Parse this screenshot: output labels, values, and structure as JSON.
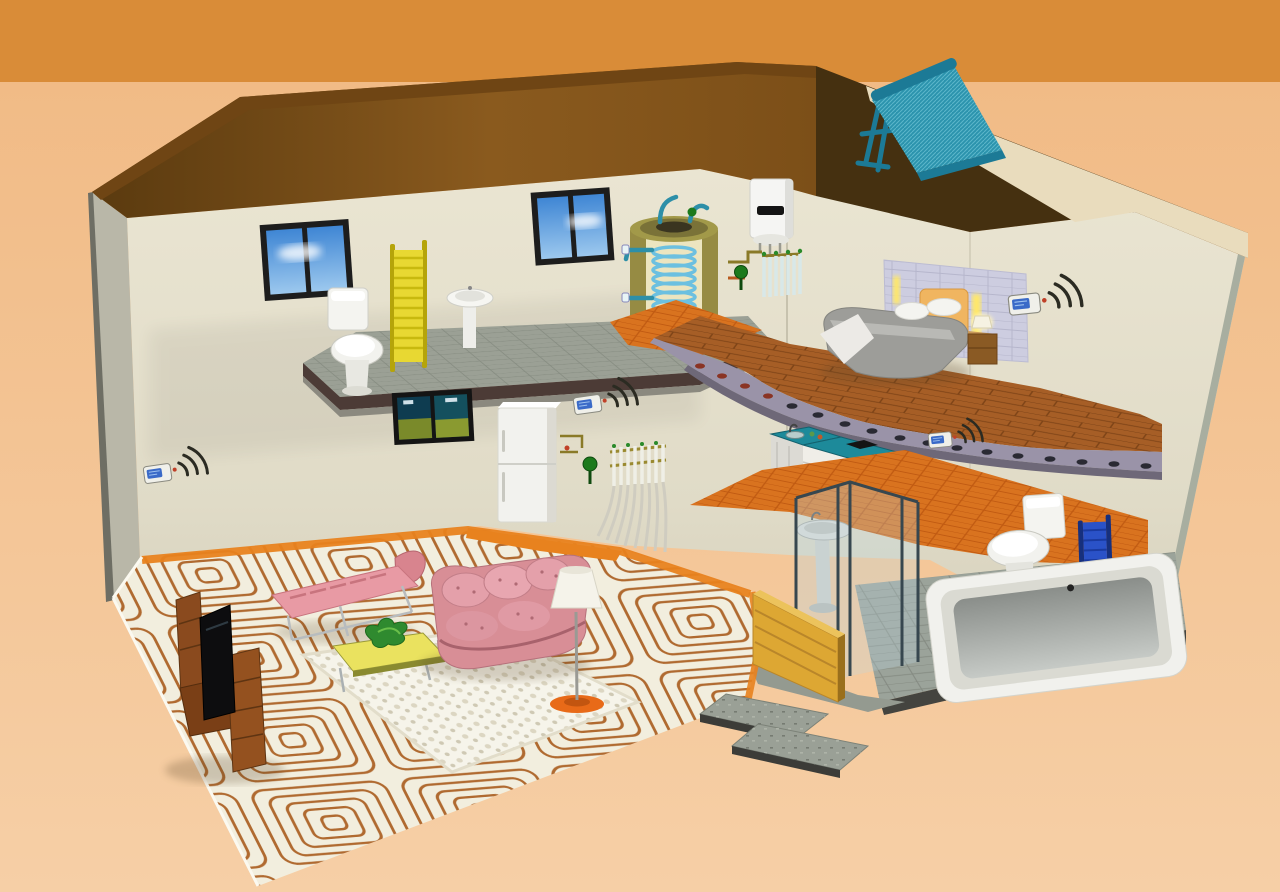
{
  "image_type": "3d-cutaway-illustration-of-home-radiant-heating-system",
  "visible_text": [],
  "colors": {
    "bg_top": "#d98c38",
    "bg_mid": "#f1bb86",
    "bg_bottom": "#f6cfa6",
    "roof_underside": "#8a5a1e",
    "roof_underside_dark": "#5a3a0f",
    "roof_ridge": "#6f4514",
    "roof_shadow": "#453010",
    "roof_lit": "#e9dcbd",
    "wall_top": "#eae5d2",
    "wall_bottom": "#d5d0bc",
    "left_wall": "#b9b7a8",
    "wall_edge": "#6e6e64",
    "slab_top": "#9ba095",
    "slab_edge_dark": "#4c3b36",
    "slab_edge_light": "#8b897f",
    "wood_floor": "#a65e26",
    "wood_line": "#7e4417",
    "tile_floor": "#d9731f",
    "tile_line": "#c05a12",
    "screed": "#f2eede",
    "coil_pipe": "#b06a30",
    "perimeter_strip": "#e8821e",
    "gray_floor": "#9ba39a",
    "collector_panel": "#2b93ad",
    "collector_frame": "#1c7a96",
    "tank_shell": "#b9ae58",
    "tank_inner": "#ece5c0",
    "tank_coil": "#6cc0e0",
    "tank_base": "#e8e0a0",
    "boiler_body": "#f5f5f3",
    "counter_top": "#1d8a9a",
    "cabinet_front": "#f0eee8",
    "sofa_pink": "#d88e96",
    "sofa_dark": "#b5717b",
    "chaise_pink": "#e89aa4",
    "wood_furniture": "#8a4a1e",
    "rug": "#f6f4ea",
    "lamp_base": "#e86a18",
    "radiator_yellow": "#e8d832",
    "radiator_blue": "#2a52c8",
    "radiator_blue_dark": "#16307e",
    "glass_tint": "#bcd7e0",
    "pump_green": "#1c7a1c",
    "sky_blue": "#4a90d8",
    "thermostat_screen": "#3a6ac8",
    "wall_tile_panel": "#cdcde0",
    "headboard": "#f0b560",
    "bed_blanket": "#9d9d99",
    "underside_band": "#9a93a8",
    "underside_band_dark": "#6e6878",
    "step_slab": "#9aa096",
    "shower_wood": "#dda733",
    "fridge_white": "#f2f2ee",
    "signal_arc": "#2b2b22"
  },
  "components": [
    "solar-collector-on-roof",
    "hot-water-storage-tank-cutaway",
    "wall-hung-boiler",
    "circulation-pump-upper",
    "circulation-pump-lower",
    "heating-manifold-upper",
    "heating-manifold-lower",
    "wireless-thermostat-left-wall",
    "wireless-thermostat-living-room",
    "wireless-thermostat-kitchen",
    "wireless-thermostat-bedroom",
    "towel-radiator-yellow-upstairs",
    "towel-radiator-blue-downstairs",
    "underfloor-heating-coils-living-room",
    "floor-heating-pipe-cross-sections-bedroom-slab",
    "window-upstairs-left",
    "window-upstairs-right",
    "toilet-upstairs",
    "pedestal-sink-upstairs",
    "bed",
    "nightstand-with-lamp",
    "headboard-tile-panel",
    "wall-art-ground-floor",
    "fridge",
    "kitchen-counter-with-sink-and-cooktop",
    "shower-glass-enclosure",
    "washbasin-in-shower",
    "wooden-half-wall",
    "toilet-downstairs",
    "bathtub",
    "tv-stand",
    "tv",
    "chaise-longue",
    "pink-sofa",
    "coffee-table-with-plant",
    "white-rug",
    "floor-lamp",
    "entrance-step-slabs"
  ]
}
